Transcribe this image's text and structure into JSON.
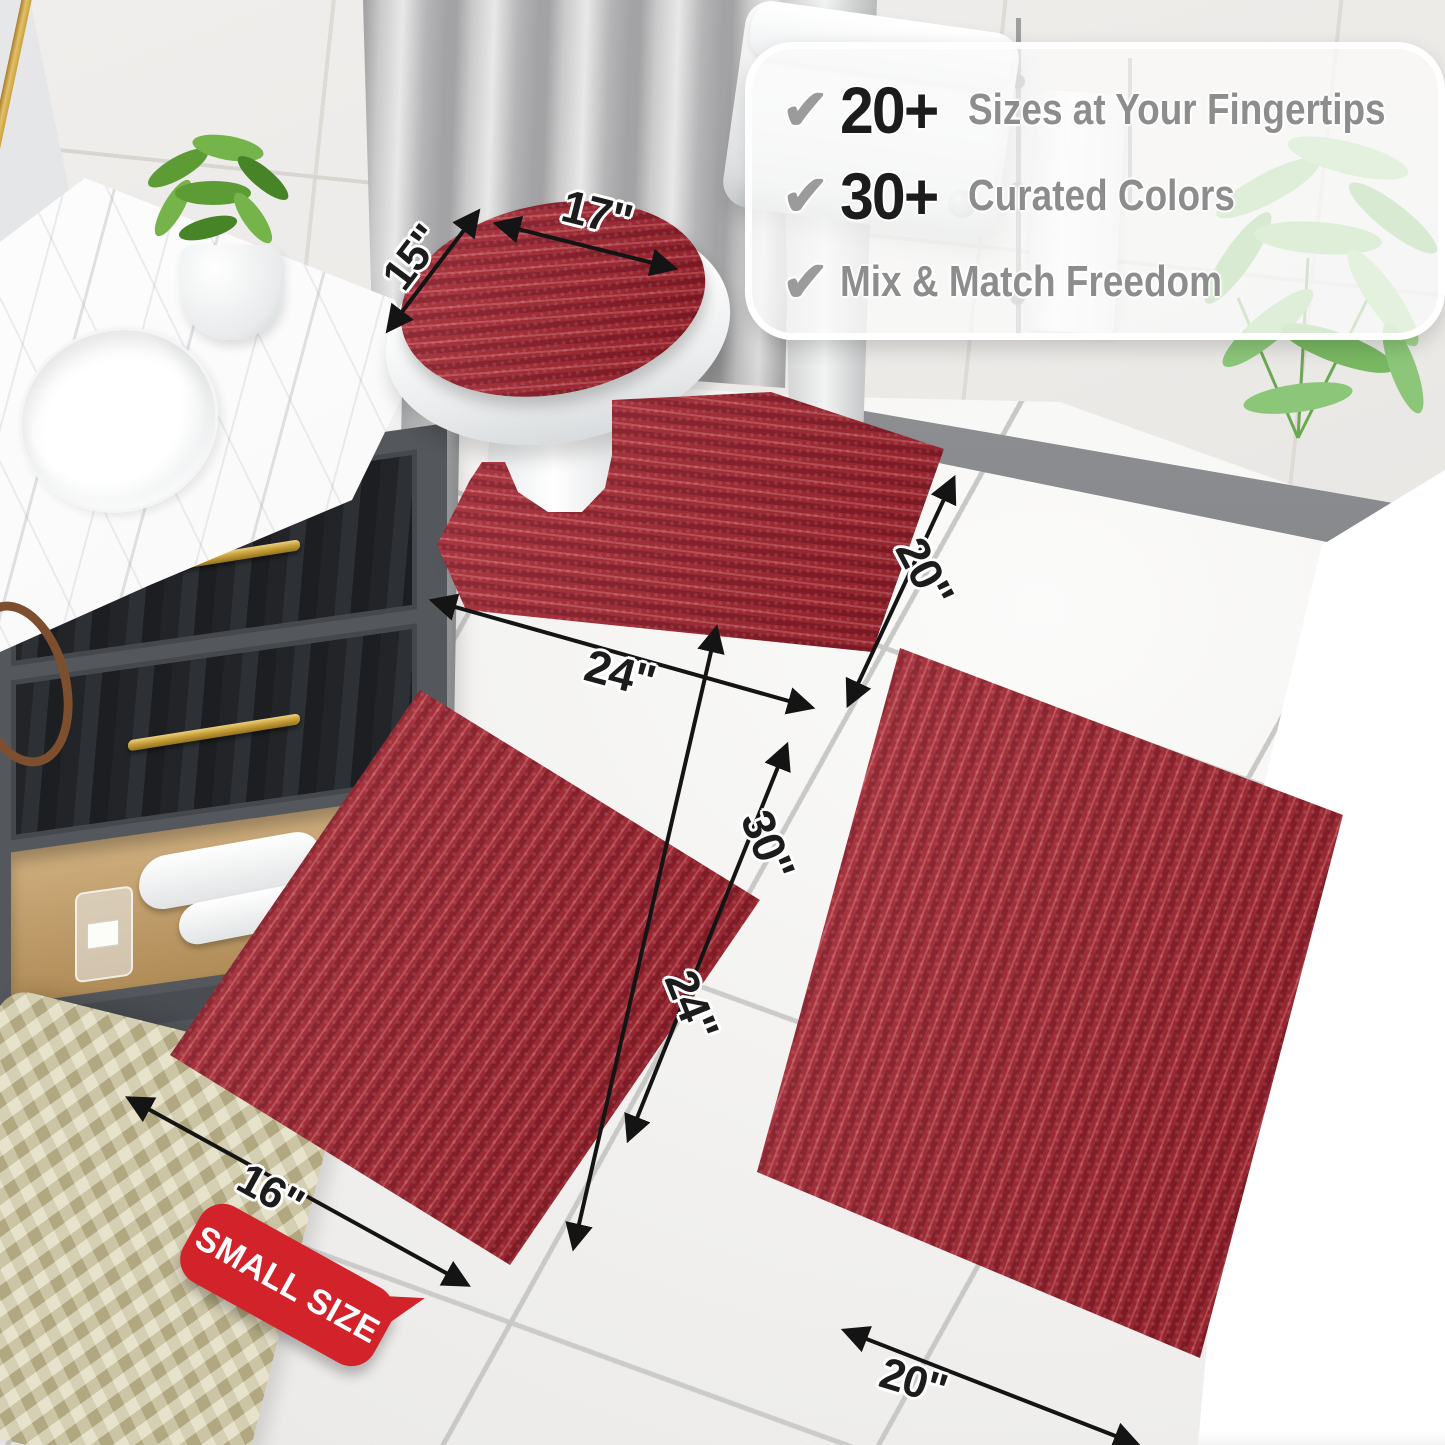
{
  "callout": {
    "check_glyph": "✔",
    "items": [
      {
        "number": "20+",
        "label": "Sizes at Your Fingertips"
      },
      {
        "number": "30+",
        "label": "Curated Colors"
      },
      {
        "number": "",
        "label": "Mix & Match Freedom"
      }
    ]
  },
  "dimensions": [
    {
      "part": "toilet-lid-cover-depth",
      "text": "15\""
    },
    {
      "part": "toilet-lid-cover-width",
      "text": "17\""
    },
    {
      "part": "contour-rug-width",
      "text": "24\""
    },
    {
      "part": "contour-rug-depth",
      "text": "20\""
    },
    {
      "part": "small-rug-width",
      "text": "16\""
    },
    {
      "part": "small-rug-length",
      "text": "24\""
    },
    {
      "part": "large-rug-length",
      "text": "30\""
    },
    {
      "part": "large-rug-width",
      "text": "20\""
    }
  ],
  "badge": {
    "text": "SMALL SIZE"
  },
  "colors": {
    "rug_base": "#a2242f",
    "rug_dark": "#871723",
    "rug_light": "#bf4a54",
    "badge_red": "#d2232b",
    "arrow_black": "#141414",
    "number_black": "#1c1c1c",
    "label_gray": "#8d8d8d",
    "gold": "#c9a23a"
  }
}
